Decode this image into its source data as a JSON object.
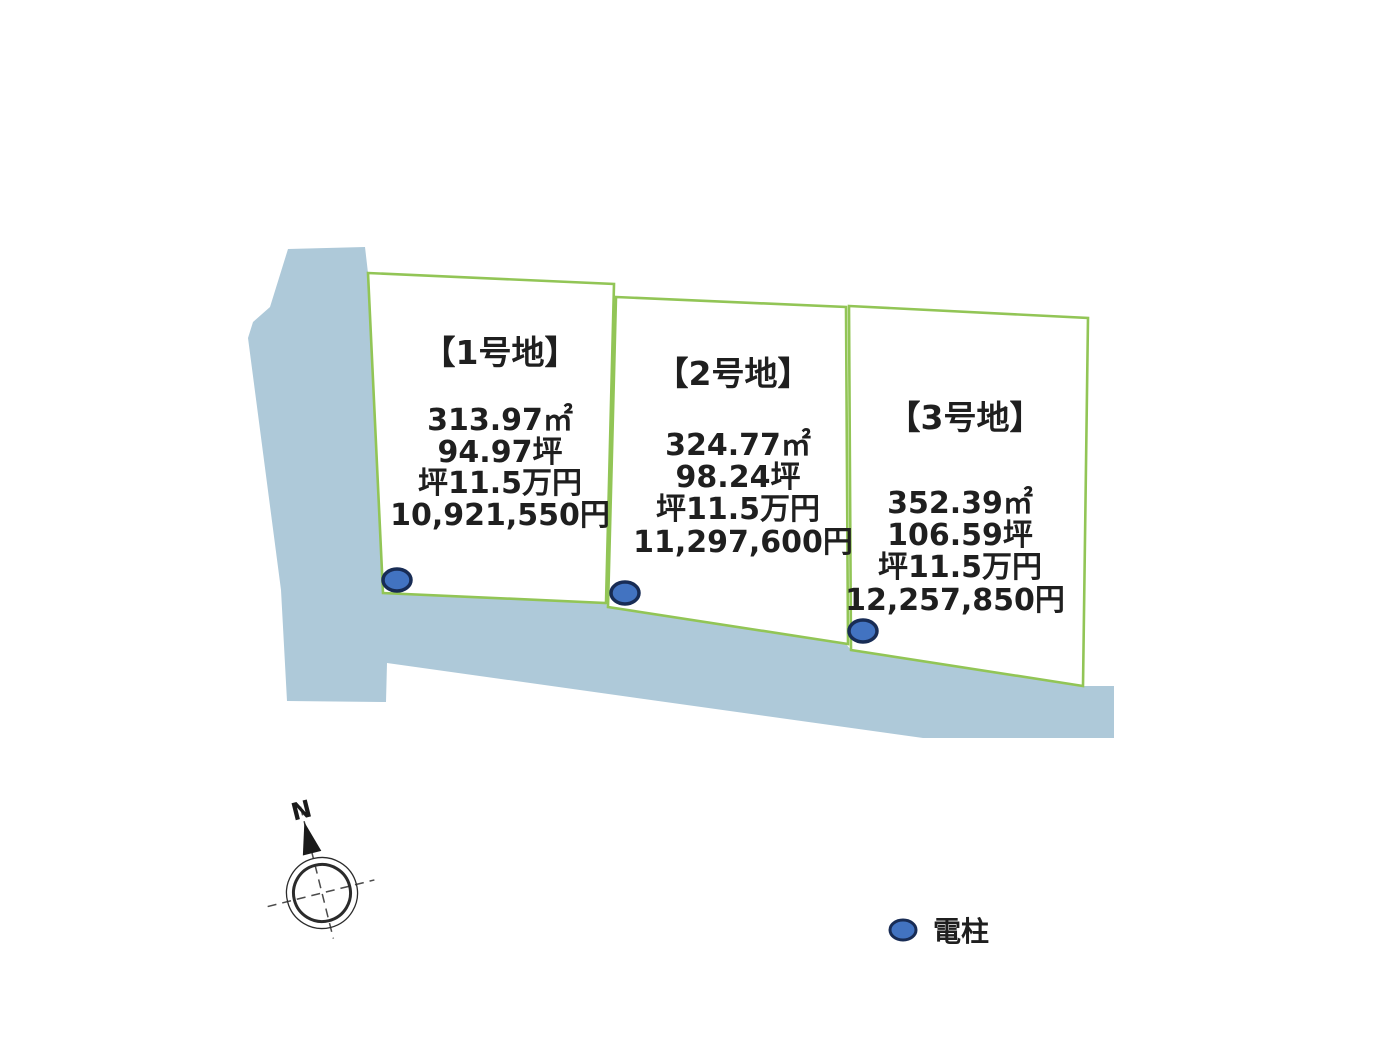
{
  "plots": [
    {
      "label": "【1号地】",
      "area_m2": "313.97㎡",
      "area_tsubo": "94.97坪",
      "unit_price": "坪11.5万円",
      "total_price": "10,921,550円"
    },
    {
      "label": "【2号地】",
      "area_m2": "324.77㎡",
      "area_tsubo": "98.24坪",
      "unit_price": "坪11.5万円",
      "total_price": "11,297,600円"
    },
    {
      "label": "【3号地】",
      "area_m2": "352.39㎡",
      "area_tsubo": "106.59坪",
      "unit_price": "坪11.5万円",
      "total_price": "12,257,850円"
    }
  ],
  "legend": {
    "pole_symbol": "utility-pole",
    "pole_label": "電柱"
  },
  "compass": {
    "north_label": "N"
  },
  "colors": {
    "road": "#aec9d9",
    "plot_fill": "#ffffff",
    "plot_border": "#92c556",
    "pole_fill": "#4273c1",
    "pole_stroke": "#182c55",
    "text": "#1f1f1f",
    "compass_line": "#4b4b4b",
    "compass_ring": "#2b2b2b",
    "compass_needle": "#1a1a1a"
  }
}
